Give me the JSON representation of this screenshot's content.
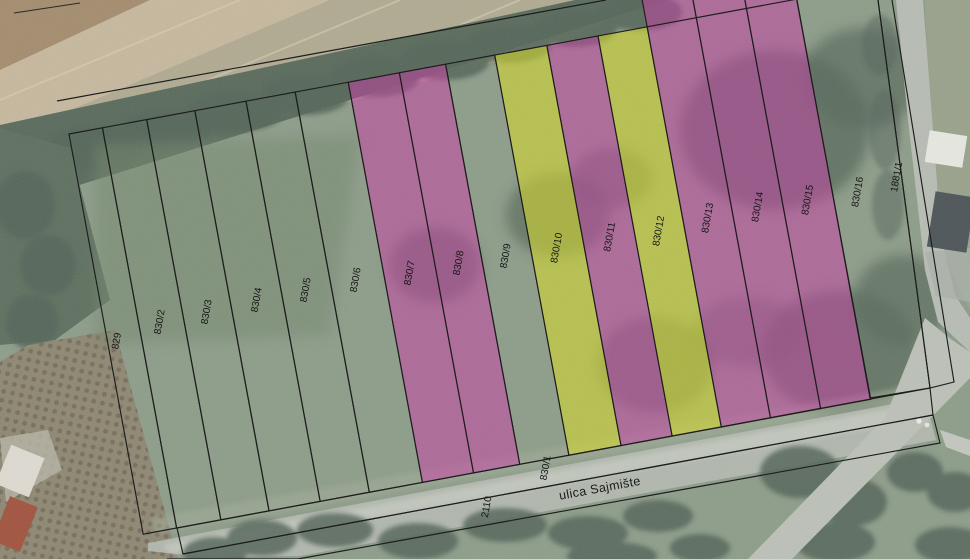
{
  "map": {
    "street": {
      "name": "ulica Sajmište",
      "label_x": 600,
      "label_y": 489,
      "angle": -10.5
    },
    "colors": {
      "magenta": "#cb3fa9",
      "yellow": "#d4d92e",
      "line": "#1d1d1d",
      "label": "#161616"
    },
    "parcels": [
      {
        "id": "829",
        "highlight": "none",
        "lx": 117,
        "ly": 341
      },
      {
        "id": "830/2",
        "highlight": "none",
        "lx": 160,
        "ly": 322
      },
      {
        "id": "830/3",
        "highlight": "none",
        "lx": 207,
        "ly": 312
      },
      {
        "id": "830/4",
        "highlight": "none",
        "lx": 257,
        "ly": 300
      },
      {
        "id": "830/5",
        "highlight": "none",
        "lx": 306,
        "ly": 290
      },
      {
        "id": "830/6",
        "highlight": "none",
        "lx": 356,
        "ly": 280
      },
      {
        "id": "830/7",
        "highlight": "magenta",
        "lx": 410,
        "ly": 273
      },
      {
        "id": "830/8",
        "highlight": "magenta",
        "lx": 459,
        "ly": 263
      },
      {
        "id": "830/9",
        "highlight": "none",
        "lx": 506,
        "ly": 256
      },
      {
        "id": "830/10",
        "highlight": "yellow",
        "lx": 557,
        "ly": 248
      },
      {
        "id": "830/11",
        "highlight": "magenta",
        "lx": 610,
        "ly": 237
      },
      {
        "id": "830/12",
        "highlight": "yellow",
        "lx": 659,
        "ly": 231
      },
      {
        "id": "830/13",
        "highlight": "magenta",
        "lx": 708,
        "ly": 218
      },
      {
        "id": "830/14",
        "highlight": "magenta",
        "lx": 758,
        "ly": 207
      },
      {
        "id": "830/15",
        "highlight": "magenta",
        "lx": 808,
        "ly": 200
      },
      {
        "id": "830/16",
        "highlight": "none",
        "lx": 858,
        "ly": 192
      },
      {
        "id": "1881/1",
        "highlight": "none",
        "lx": 897,
        "ly": 177
      },
      {
        "id": "830/1",
        "highlight": "none",
        "lx": 546,
        "ly": 468
      },
      {
        "id": "2110",
        "highlight": "none",
        "lx": 487,
        "ly": 507
      }
    ]
  }
}
